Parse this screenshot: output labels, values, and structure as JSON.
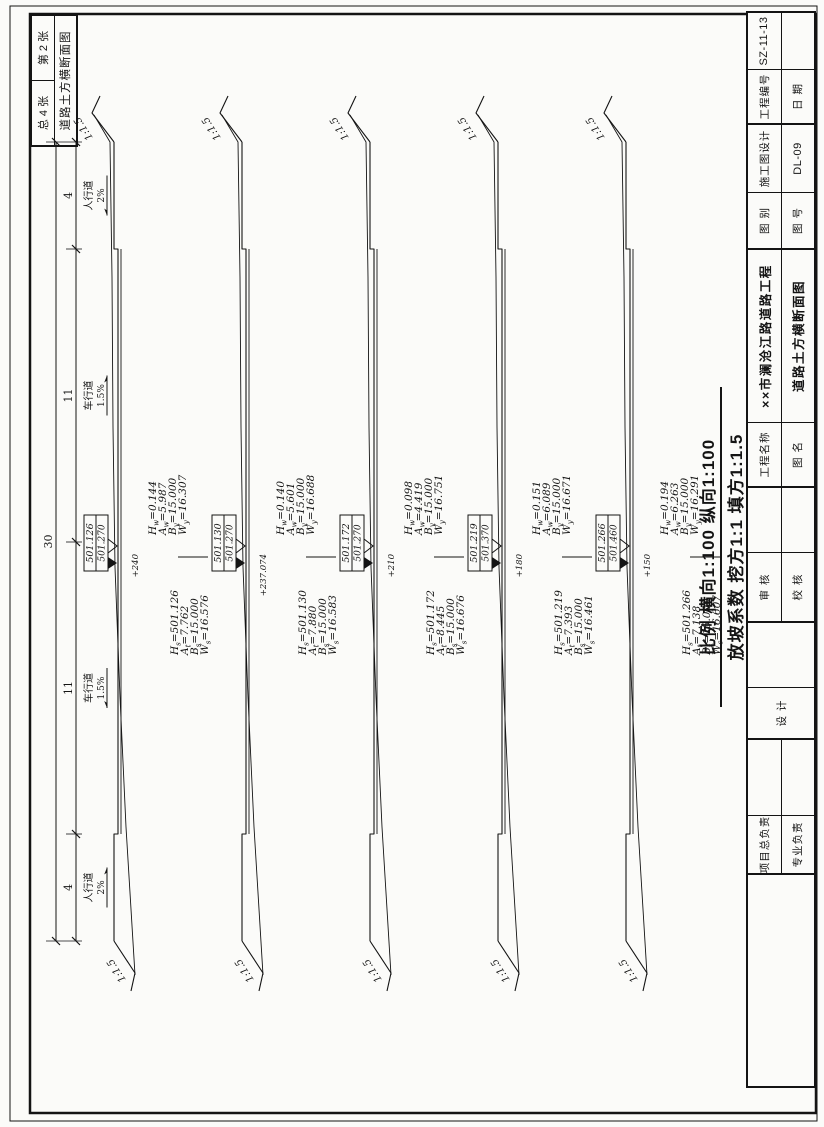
{
  "sheet": {
    "pages_table": {
      "total": "总 4 张",
      "current": "第 2 张",
      "sheet_title": "道路土方横断面图"
    },
    "dim_header": {
      "total": "30",
      "segments": [
        "4",
        "11",
        "11",
        "4"
      ],
      "lanes": [
        {
          "label": "人行道",
          "slope": "2%"
        },
        {
          "label": "车行道",
          "slope": "1.5%"
        },
        {
          "label": "车行道",
          "slope": "1.5%"
        },
        {
          "label": "人行道",
          "slope": "2%"
        }
      ]
    },
    "slope_label": "1:1.5",
    "notes": {
      "scale_line": "比例 横向1:100 纵向1:100",
      "grade_line": "放坡系数 挖方1:1 填方1:1.5"
    },
    "sections": [
      {
        "station": "+240",
        "flag_design": "501.126",
        "flag_ground": "501.270",
        "left_block": [
          {
            "sym": "H",
            "sub": "s",
            "val": "=501.126"
          },
          {
            "sym": "A",
            "sub": "t",
            "val": "=7.762"
          },
          {
            "sym": "B",
            "sub": "s",
            "val": "=15.000"
          },
          {
            "sym": "W",
            "sub": "s",
            "val": "=16.576"
          }
        ],
        "right_block": [
          {
            "sym": "H",
            "sub": "w",
            "val": "=0.144"
          },
          {
            "sym": "A",
            "sub": "w",
            "val": "=5.987"
          },
          {
            "sym": "B",
            "sub": "y",
            "val": "=15.000"
          },
          {
            "sym": "W",
            "sub": "y",
            "val": "=16.307"
          }
        ]
      },
      {
        "station": "+237.074",
        "flag_design": "501.130",
        "flag_ground": "501.270",
        "left_block": [
          {
            "sym": "H",
            "sub": "s",
            "val": "=501.130"
          },
          {
            "sym": "A",
            "sub": "t",
            "val": "=7.880"
          },
          {
            "sym": "B",
            "sub": "s",
            "val": "=15.000"
          },
          {
            "sym": "W",
            "sub": "s",
            "val": "=16.583"
          }
        ],
        "right_block": [
          {
            "sym": "H",
            "sub": "w",
            "val": "=0.140"
          },
          {
            "sym": "A",
            "sub": "w",
            "val": "=5.601"
          },
          {
            "sym": "B",
            "sub": "y",
            "val": "=15.000"
          },
          {
            "sym": "W",
            "sub": "y",
            "val": "=16.688"
          }
        ]
      },
      {
        "station": "+210",
        "flag_design": "501.172",
        "flag_ground": "501.270",
        "left_block": [
          {
            "sym": "H",
            "sub": "s",
            "val": "=501.172"
          },
          {
            "sym": "A",
            "sub": "t",
            "val": "=8.445"
          },
          {
            "sym": "B",
            "sub": "s",
            "val": "=15.000"
          },
          {
            "sym": "W",
            "sub": "s",
            "val": "=16.676"
          }
        ],
        "right_block": [
          {
            "sym": "H",
            "sub": "w",
            "val": "=0.098"
          },
          {
            "sym": "A",
            "sub": "w",
            "val": "=4.419"
          },
          {
            "sym": "B",
            "sub": "y",
            "val": "=15.000"
          },
          {
            "sym": "W",
            "sub": "y",
            "val": "=16.751"
          }
        ]
      },
      {
        "station": "+180",
        "flag_design": "501.219",
        "flag_ground": "501.370",
        "left_block": [
          {
            "sym": "H",
            "sub": "s",
            "val": "=501.219"
          },
          {
            "sym": "A",
            "sub": "t",
            "val": "=7.393"
          },
          {
            "sym": "B",
            "sub": "s",
            "val": "=15.000"
          },
          {
            "sym": "W",
            "sub": "s",
            "val": "=16.461"
          }
        ],
        "right_block": [
          {
            "sym": "H",
            "sub": "w",
            "val": "=0.151"
          },
          {
            "sym": "A",
            "sub": "w",
            "val": "=6.089"
          },
          {
            "sym": "B",
            "sub": "y",
            "val": "=15.000"
          },
          {
            "sym": "W",
            "sub": "y",
            "val": "=16.671"
          }
        ]
      },
      {
        "station": "+150",
        "flag_design": "501.266",
        "flag_ground": "501.460",
        "left_block": [
          {
            "sym": "H",
            "sub": "s",
            "val": "=501.266"
          },
          {
            "sym": "A",
            "sub": "t",
            "val": "=7.138"
          },
          {
            "sym": "B",
            "sub": "s",
            "val": "=15.000"
          },
          {
            "sym": "W",
            "sub": "s",
            "val": "=16.607"
          }
        ],
        "right_block": [
          {
            "sym": "H",
            "sub": "w",
            "val": "=0.194"
          },
          {
            "sym": "A",
            "sub": "w",
            "val": "=6.263"
          },
          {
            "sym": "B",
            "sub": "y",
            "val": "=15.000"
          },
          {
            "sym": "W",
            "sub": "y",
            "val": "=16.291"
          }
        ]
      }
    ],
    "title_block": {
      "pm_label": "项目总负责",
      "lead_label": "专业负责",
      "design_label": "设 计",
      "review_label": "审 核",
      "check_label": "校 核",
      "project_name_label": "工程名称",
      "project_name": "××市澜沧江路道路工程",
      "drawing_name_label": "图 名",
      "drawing_name": "道路土方横断面图",
      "category_label": "图 别",
      "category": "施工图设计",
      "number_label": "图 号",
      "number": "DL-09",
      "code_label": "工程编号",
      "code": "SZ-11-13",
      "date_label": "日 期",
      "date": ""
    }
  }
}
